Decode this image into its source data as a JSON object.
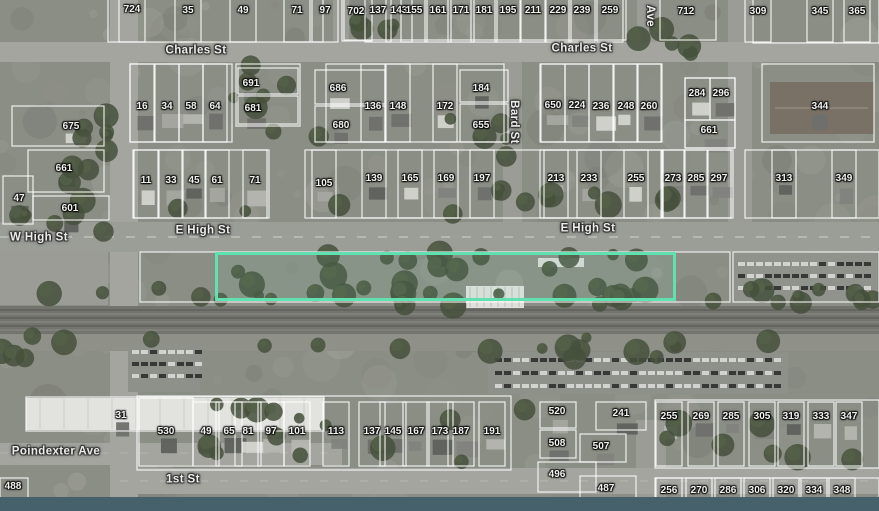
{
  "map": {
    "type": "aerial-parcel-map",
    "highlight_color": "#5fe2b0",
    "bottom_bar_color": "#46616c",
    "highlight_parcel": {
      "x": 215,
      "y": 252,
      "w": 461,
      "h": 49
    },
    "street_labels": [
      {
        "text": "Charles St",
        "x": 196,
        "y": 51,
        "rot": 0
      },
      {
        "text": "Charles St",
        "x": 582,
        "y": 49,
        "rot": 0
      },
      {
        "text": "W High St",
        "x": 39,
        "y": 238,
        "rot": 0
      },
      {
        "text": "E High St",
        "x": 203,
        "y": 231,
        "rot": 0
      },
      {
        "text": "E High St",
        "x": 588,
        "y": 229,
        "rot": 0
      },
      {
        "text": "Bard St",
        "x": 513,
        "y": 122,
        "rot": 90
      },
      {
        "text": "Ave",
        "x": 649,
        "y": 16,
        "rot": 90
      },
      {
        "text": "Poindexter Ave",
        "x": 56,
        "y": 452,
        "rot": 0
      },
      {
        "text": "1st St",
        "x": 183,
        "y": 480,
        "rot": 0
      }
    ],
    "parcel_labels": [
      {
        "t": "724",
        "x": 132,
        "y": 10
      },
      {
        "t": "35",
        "x": 188,
        "y": 11
      },
      {
        "t": "49",
        "x": 243,
        "y": 11
      },
      {
        "t": "71",
        "x": 297,
        "y": 11
      },
      {
        "t": "97",
        "x": 325,
        "y": 11
      },
      {
        "t": "702",
        "x": 356,
        "y": 12,
        "lot": [
          342,
          -3,
          30,
          44
        ]
      },
      {
        "t": "137",
        "x": 378,
        "y": 11
      },
      {
        "t": "143",
        "x": 399,
        "y": 11
      },
      {
        "t": "155",
        "x": 414,
        "y": 11
      },
      {
        "t": "161",
        "x": 438,
        "y": 11
      },
      {
        "t": "171",
        "x": 461,
        "y": 11
      },
      {
        "t": "181",
        "x": 484,
        "y": 11
      },
      {
        "t": "195",
        "x": 508,
        "y": 11
      },
      {
        "t": "211",
        "x": 533,
        "y": 11
      },
      {
        "t": "229",
        "x": 558,
        "y": 11
      },
      {
        "t": "239",
        "x": 582,
        "y": 11
      },
      {
        "t": "259",
        "x": 610,
        "y": 11
      },
      {
        "t": "712",
        "x": 686,
        "y": 12,
        "lot": [
          660,
          -3,
          56,
          43
        ]
      },
      {
        "t": "309",
        "x": 758,
        "y": 12
      },
      {
        "t": "345",
        "x": 820,
        "y": 12
      },
      {
        "t": "365",
        "x": 857,
        "y": 12
      },
      {
        "t": "675",
        "x": 71,
        "y": 127,
        "lot": [
          12,
          106,
          92,
          40
        ]
      },
      {
        "t": "16",
        "x": 142,
        "y": 107
      },
      {
        "t": "34",
        "x": 167,
        "y": 107
      },
      {
        "t": "58",
        "x": 191,
        "y": 107
      },
      {
        "t": "64",
        "x": 215,
        "y": 107
      },
      {
        "t": "691",
        "x": 251,
        "y": 84,
        "lot": [
          238,
          68,
          60,
          26
        ]
      },
      {
        "t": "681",
        "x": 253,
        "y": 109,
        "lot": [
          238,
          96,
          60,
          28
        ]
      },
      {
        "t": "686",
        "x": 338,
        "y": 89,
        "lot": [
          315,
          70,
          70,
          34
        ]
      },
      {
        "t": "680",
        "x": 341,
        "y": 126,
        "lot": [
          315,
          106,
          70,
          36
        ]
      },
      {
        "t": "136",
        "x": 373,
        "y": 107
      },
      {
        "t": "148",
        "x": 398,
        "y": 107
      },
      {
        "t": "172",
        "x": 445,
        "y": 107
      },
      {
        "t": "184",
        "x": 481,
        "y": 89,
        "lot": [
          460,
          70,
          48,
          32
        ]
      },
      {
        "t": "655",
        "x": 481,
        "y": 126,
        "lot": [
          460,
          104,
          48,
          38
        ]
      },
      {
        "t": "650",
        "x": 553,
        "y": 106
      },
      {
        "t": "224",
        "x": 577,
        "y": 106
      },
      {
        "t": "236",
        "x": 601,
        "y": 107
      },
      {
        "t": "248",
        "x": 626,
        "y": 107
      },
      {
        "t": "260",
        "x": 649,
        "y": 107
      },
      {
        "t": "284",
        "x": 697,
        "y": 94,
        "lot": [
          685,
          78,
          25,
          42
        ]
      },
      {
        "t": "296",
        "x": 721,
        "y": 94,
        "lot": [
          710,
          78,
          25,
          42
        ]
      },
      {
        "t": "661",
        "x": 709,
        "y": 131,
        "lot": [
          685,
          120,
          50,
          28
        ]
      },
      {
        "t": "344",
        "x": 820,
        "y": 107,
        "lot": [
          762,
          64,
          112,
          78
        ]
      },
      {
        "t": "661",
        "x": 64,
        "y": 169,
        "lot": [
          28,
          150,
          76,
          42
        ]
      },
      {
        "t": "47",
        "x": 19,
        "y": 199,
        "lot": [
          3,
          176,
          30,
          48
        ]
      },
      {
        "t": "601",
        "x": 70,
        "y": 209,
        "lot": [
          33,
          196,
          76,
          24
        ]
      },
      {
        "t": "11",
        "x": 146,
        "y": 181
      },
      {
        "t": "33",
        "x": 171,
        "y": 181
      },
      {
        "t": "45",
        "x": 194,
        "y": 181
      },
      {
        "t": "61",
        "x": 217,
        "y": 181
      },
      {
        "t": "71",
        "x": 255,
        "y": 181
      },
      {
        "t": "105",
        "x": 324,
        "y": 184
      },
      {
        "t": "139",
        "x": 374,
        "y": 179
      },
      {
        "t": "165",
        "x": 410,
        "y": 179
      },
      {
        "t": "169",
        "x": 446,
        "y": 179
      },
      {
        "t": "197",
        "x": 482,
        "y": 179
      },
      {
        "t": "213",
        "x": 556,
        "y": 179
      },
      {
        "t": "233",
        "x": 589,
        "y": 179
      },
      {
        "t": "255",
        "x": 636,
        "y": 179
      },
      {
        "t": "273",
        "x": 673,
        "y": 179
      },
      {
        "t": "285",
        "x": 696,
        "y": 179
      },
      {
        "t": "297",
        "x": 719,
        "y": 179
      },
      {
        "t": "313",
        "x": 784,
        "y": 179
      },
      {
        "t": "349",
        "x": 844,
        "y": 179
      },
      {
        "t": "31",
        "x": 121,
        "y": 416,
        "lot": [
          26,
          397,
          298,
          34
        ]
      },
      {
        "t": "530",
        "x": 166,
        "y": 432,
        "lot": [
          139,
          398,
          54,
          68
        ]
      },
      {
        "t": "49",
        "x": 206,
        "y": 432
      },
      {
        "t": "65",
        "x": 229,
        "y": 432
      },
      {
        "t": "81",
        "x": 248,
        "y": 432
      },
      {
        "t": "97",
        "x": 271,
        "y": 432
      },
      {
        "t": "101",
        "x": 297,
        "y": 432
      },
      {
        "t": "113",
        "x": 336,
        "y": 432
      },
      {
        "t": "137",
        "x": 372,
        "y": 432
      },
      {
        "t": "145",
        "x": 393,
        "y": 432
      },
      {
        "t": "167",
        "x": 416,
        "y": 432
      },
      {
        "t": "173",
        "x": 440,
        "y": 432
      },
      {
        "t": "187",
        "x": 461,
        "y": 432
      },
      {
        "t": "191",
        "x": 492,
        "y": 432
      },
      {
        "t": "520",
        "x": 557,
        "y": 412,
        "lot": [
          540,
          402,
          36,
          26
        ]
      },
      {
        "t": "508",
        "x": 557,
        "y": 444,
        "lot": [
          540,
          430,
          36,
          28
        ]
      },
      {
        "t": "241",
        "x": 621,
        "y": 414,
        "lot": [
          596,
          402,
          50,
          28
        ]
      },
      {
        "t": "507",
        "x": 601,
        "y": 447,
        "lot": [
          580,
          434,
          46,
          28
        ]
      },
      {
        "t": "255",
        "x": 669,
        "y": 417
      },
      {
        "t": "269",
        "x": 701,
        "y": 417
      },
      {
        "t": "285",
        "x": 731,
        "y": 417
      },
      {
        "t": "305",
        "x": 762,
        "y": 417
      },
      {
        "t": "319",
        "x": 791,
        "y": 417
      },
      {
        "t": "333",
        "x": 821,
        "y": 417
      },
      {
        "t": "347",
        "x": 849,
        "y": 417
      },
      {
        "t": "488",
        "x": 13,
        "y": 487,
        "lot": [
          0,
          478,
          28,
          22
        ]
      },
      {
        "t": "496",
        "x": 557,
        "y": 475,
        "lot": [
          538,
          462,
          58,
          30
        ]
      },
      {
        "t": "487",
        "x": 606,
        "y": 489,
        "lot": [
          580,
          476,
          56,
          28
        ]
      },
      {
        "t": "256",
        "x": 669,
        "y": 491
      },
      {
        "t": "270",
        "x": 699,
        "y": 491
      },
      {
        "t": "286",
        "x": 728,
        "y": 491
      },
      {
        "t": "306",
        "x": 757,
        "y": 491
      },
      {
        "t": "320",
        "x": 786,
        "y": 491
      },
      {
        "t": "334",
        "x": 814,
        "y": 491
      },
      {
        "t": "348",
        "x": 842,
        "y": 491
      }
    ]
  }
}
